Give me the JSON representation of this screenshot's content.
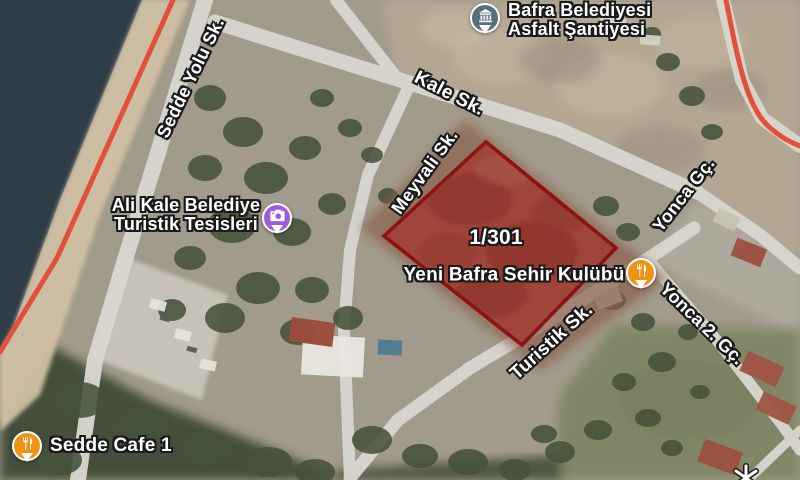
{
  "map": {
    "view_type": "satellite",
    "parcel": {
      "label": "1/301",
      "outline_color": "#8E1414",
      "fill_color": "rgba(168,34,34,0.42)"
    },
    "route_color": "#E2503A",
    "water_color": "#2F3D47",
    "streets": [
      "Sedde Yolu Sk.",
      "Kale Sk.",
      "Meyvali Sk.",
      "Yonca Gç.",
      "Turistik Sk.",
      "Yonca 2. Gç."
    ],
    "places": [
      {
        "name": "Bafra Belediyesi Asfalt Şantiyesi",
        "line1": "Bafra Belediyesi",
        "line2": "Asfalt Şantiyesi",
        "icon": "government-building-icon",
        "pin_color": "#56707E"
      },
      {
        "name": "Ali Kale Belediye Turistik Tesisleri",
        "line1": "Ali Kale Belediye",
        "line2": "Turistik Tesisleri",
        "icon": "camera-icon",
        "pin_color": "#A05CD9"
      },
      {
        "name": "Yeni Bafra Sehir Kulübü",
        "icon": "restaurant-icon",
        "pin_color": "#F09313"
      },
      {
        "name": "Sedde Cafe 1",
        "icon": "restaurant-icon",
        "pin_color": "#F09313"
      }
    ]
  }
}
